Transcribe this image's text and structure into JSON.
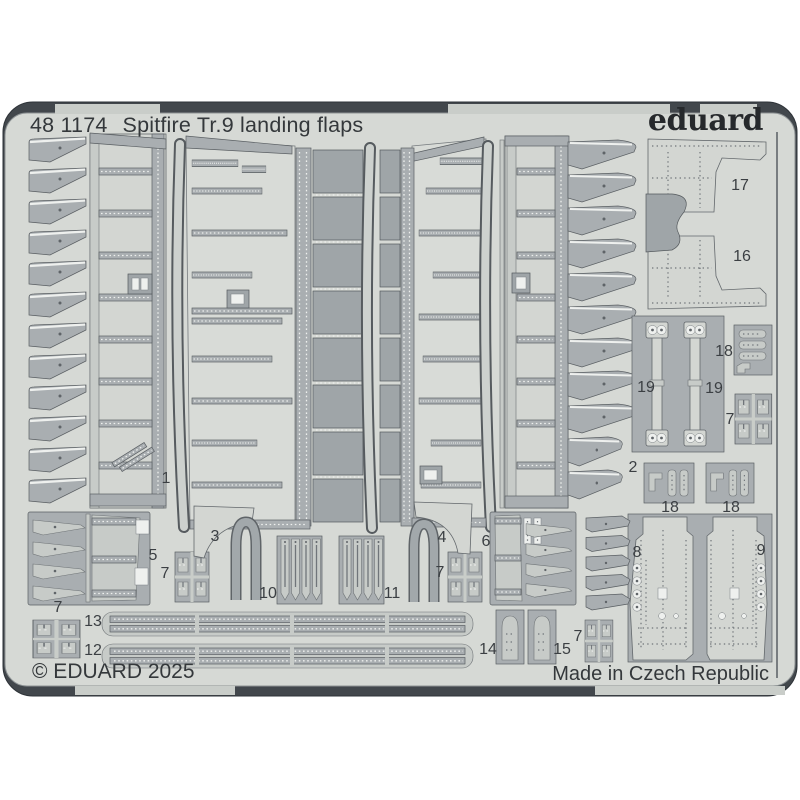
{
  "header": {
    "catalog_number": "48 1174",
    "title": "Spitfire Tr.9 landing flaps",
    "brand": "eduard"
  },
  "footer": {
    "copyright": "© EDUARD 2025",
    "origin": "Made in Czech Republic"
  },
  "colors": {
    "page_background": "#ffffff",
    "fret_sheet": "#d6d9d5",
    "part_gray": "#a9aeb1",
    "etched_dark": "#42474c",
    "text": "#34383b"
  },
  "part_labels": [
    {
      "label": "1",
      "x": 166,
      "y": 479
    },
    {
      "label": "2",
      "x": 633,
      "y": 468
    },
    {
      "label": "3",
      "x": 215,
      "y": 537
    },
    {
      "label": "4",
      "x": 442,
      "y": 538
    },
    {
      "label": "5",
      "x": 153,
      "y": 556
    },
    {
      "label": "6",
      "x": 486,
      "y": 542
    },
    {
      "label": "7",
      "x": 165,
      "y": 574
    },
    {
      "label": "7",
      "x": 440,
      "y": 573
    },
    {
      "label": "7",
      "x": 58,
      "y": 608
    },
    {
      "label": "7",
      "x": 578,
      "y": 637
    },
    {
      "label": "7",
      "x": 730,
      "y": 420
    },
    {
      "label": "8",
      "x": 637,
      "y": 553
    },
    {
      "label": "9",
      "x": 761,
      "y": 551
    },
    {
      "label": "10",
      "x": 268,
      "y": 594
    },
    {
      "label": "11",
      "x": 392,
      "y": 594
    },
    {
      "label": "12",
      "x": 93,
      "y": 651
    },
    {
      "label": "13",
      "x": 93,
      "y": 622
    },
    {
      "label": "14",
      "x": 488,
      "y": 650
    },
    {
      "label": "15",
      "x": 562,
      "y": 650
    },
    {
      "label": "16",
      "x": 742,
      "y": 257
    },
    {
      "label": "17",
      "x": 740,
      "y": 186
    },
    {
      "label": "18",
      "x": 724,
      "y": 352
    },
    {
      "label": "18",
      "x": 670,
      "y": 508
    },
    {
      "label": "18",
      "x": 731,
      "y": 508
    },
    {
      "label": "19",
      "x": 646,
      "y": 388
    },
    {
      "label": "19",
      "x": 714,
      "y": 389
    }
  ]
}
